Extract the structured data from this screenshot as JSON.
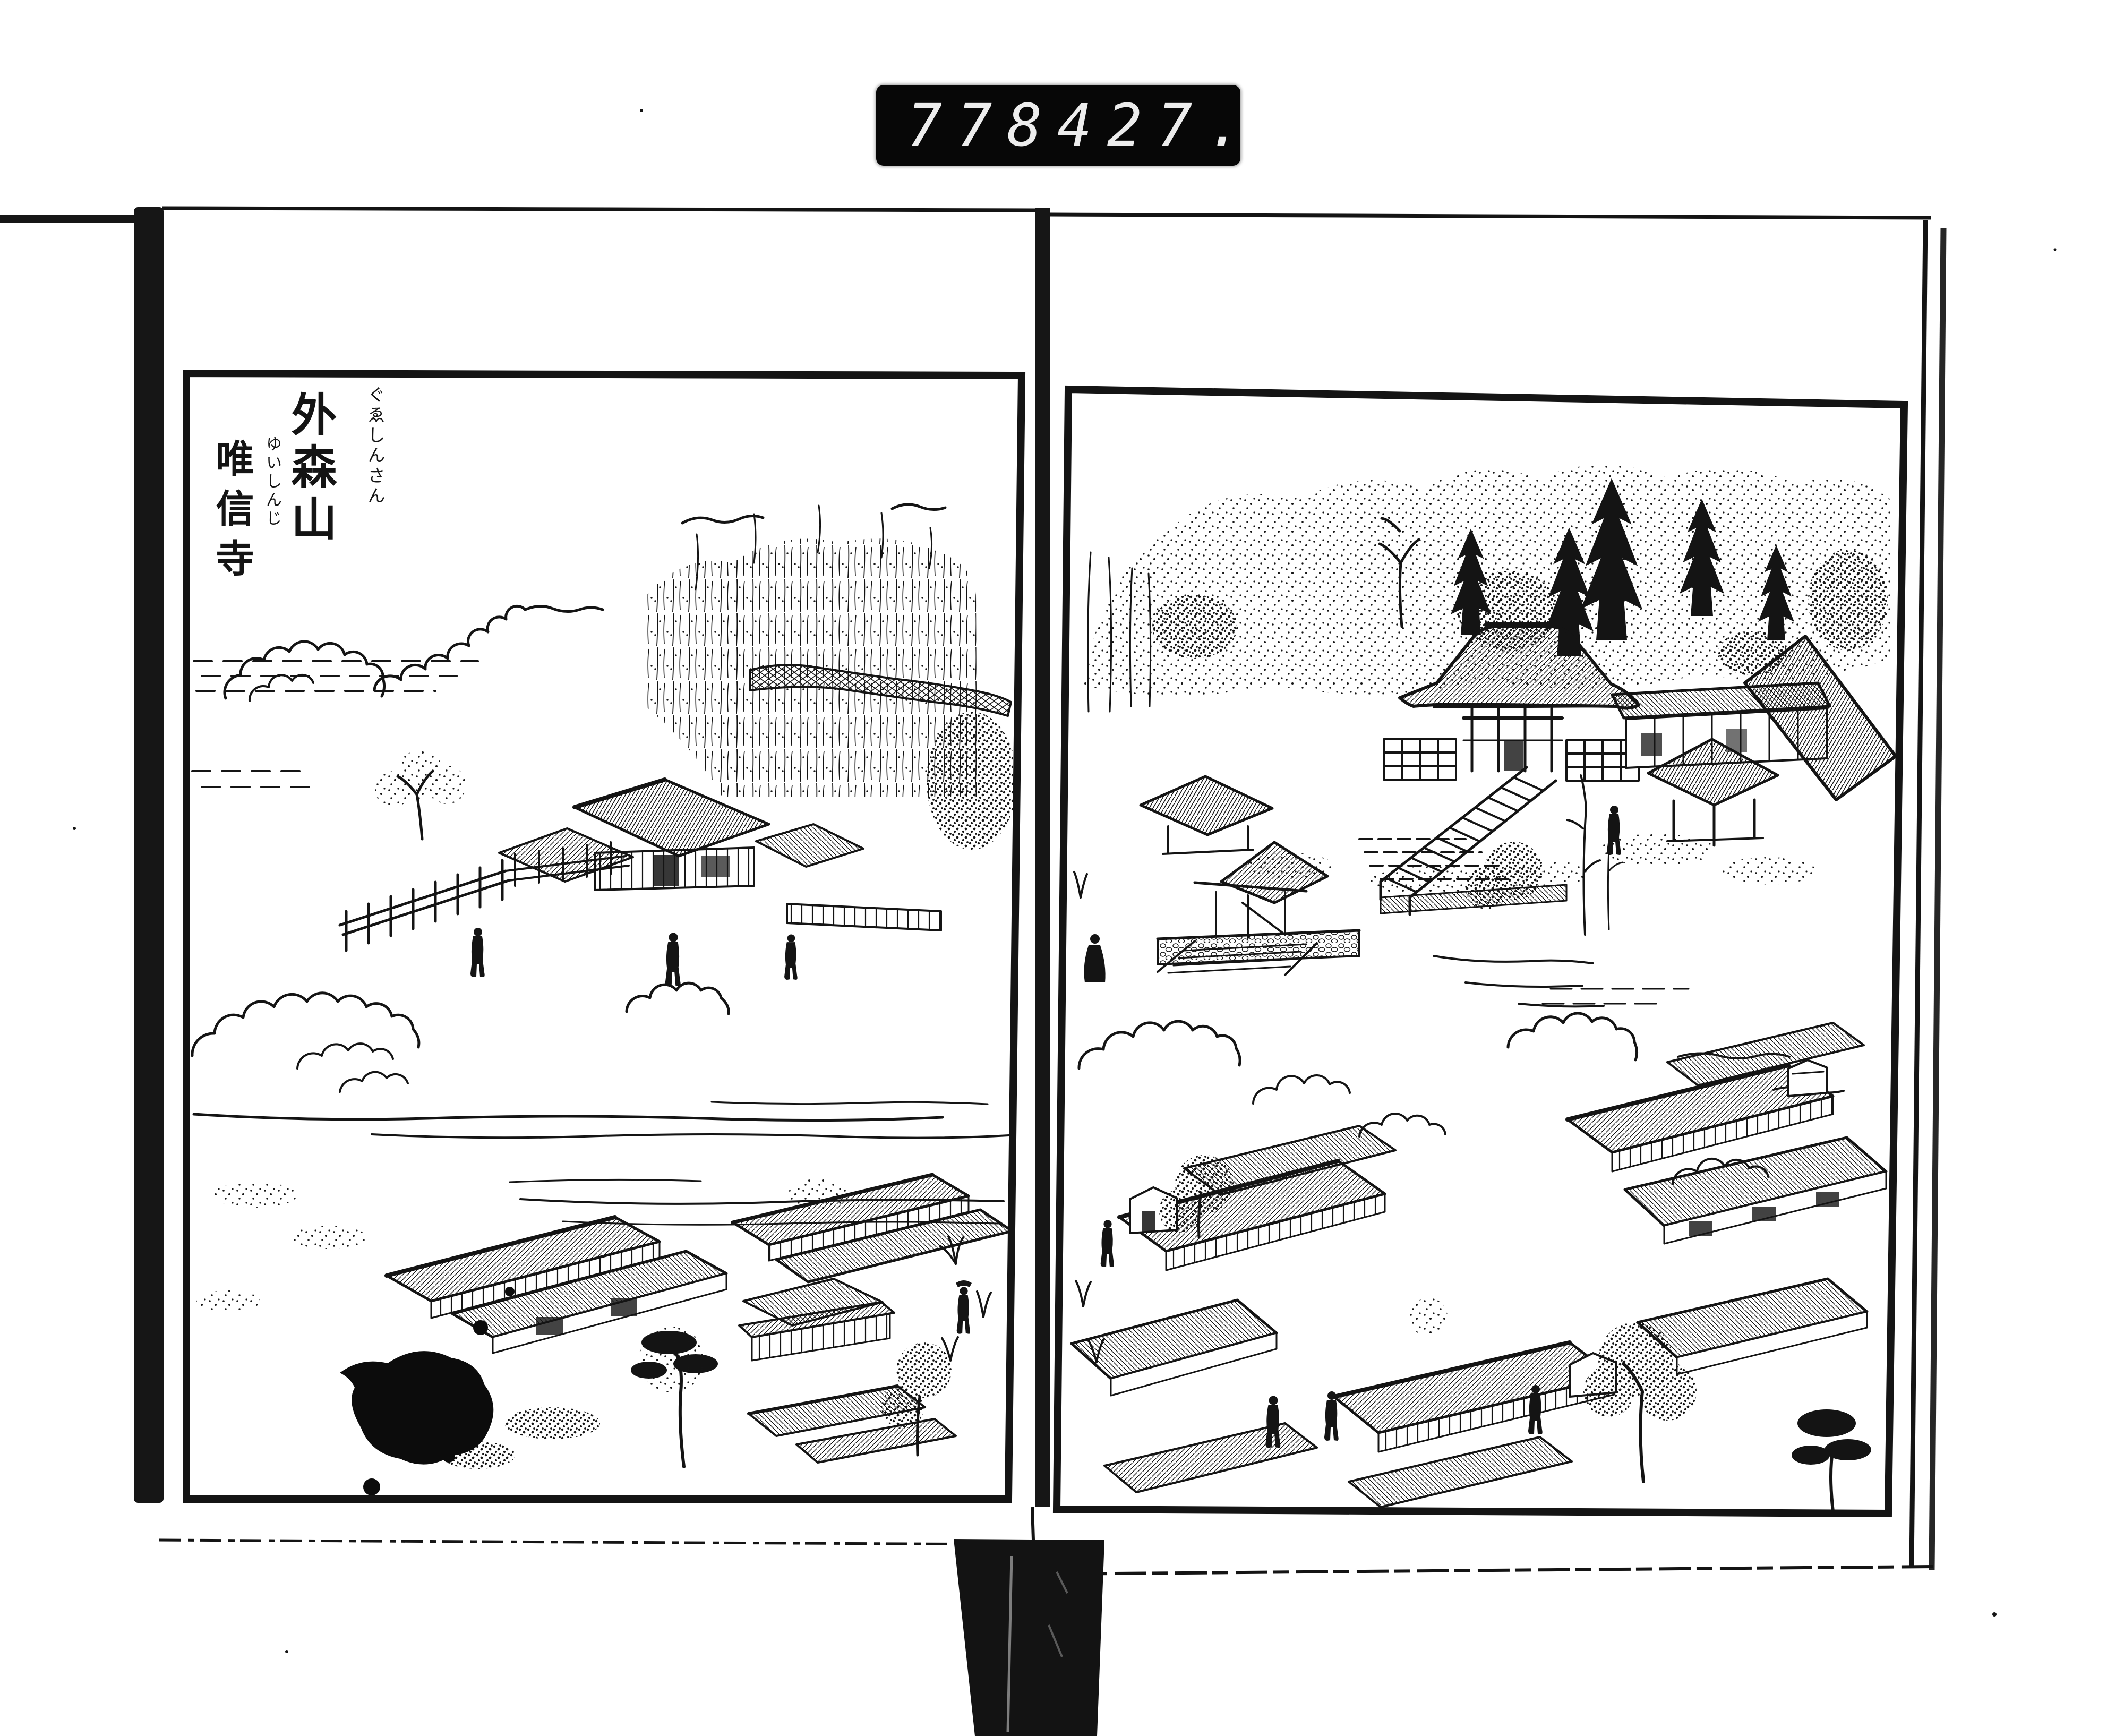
{
  "document": {
    "kind": "scanned illustrated book spread",
    "counter": {
      "left_digits": "778",
      "right_digits": "427."
    },
    "left_page": {
      "title_main": "外森山",
      "title_main_furigana": "ぐゑしんさん",
      "title_sub": "唯信寺",
      "title_sub_furigana": "ゆいしんじ"
    }
  },
  "colors": {
    "paper": "#ffffff",
    "ink": "#141414",
    "counter_background": "#070707",
    "counter_digits": "#ededed"
  }
}
